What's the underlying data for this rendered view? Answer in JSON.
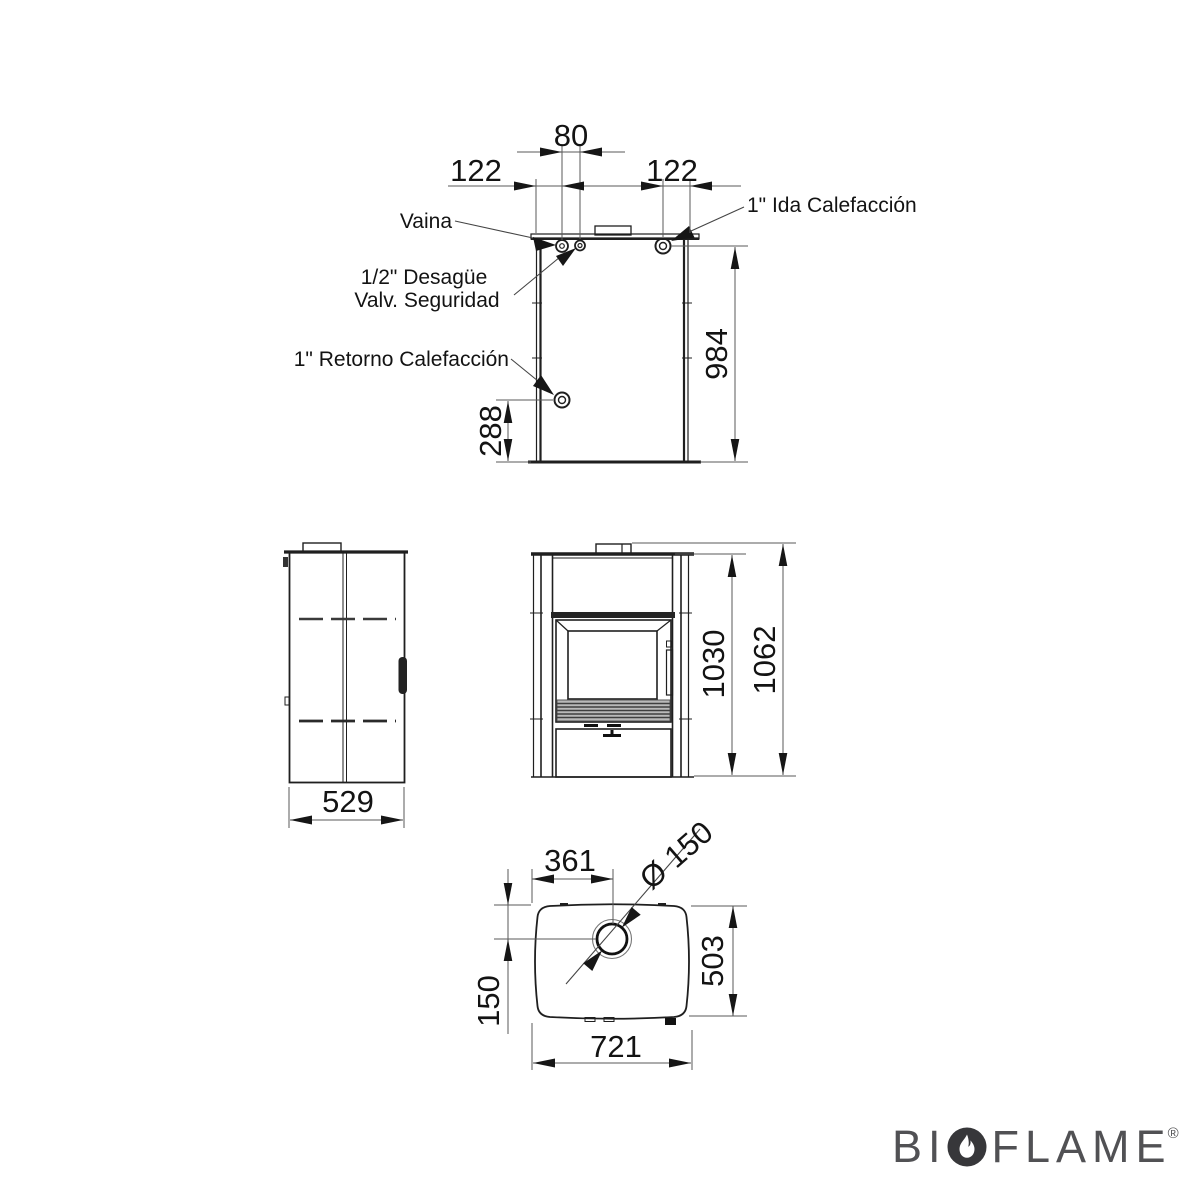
{
  "rear_view": {
    "dims": {
      "hole_spacing": "80",
      "offset_left": "122",
      "offset_right": "122",
      "height": "984",
      "return_height": "288"
    },
    "callouts": {
      "vaina": "Vaina",
      "drain_line1": "1/2\" Desagüe",
      "drain_line2": "Valv. Seguridad",
      "return_label": "1\" Retorno Calefacción",
      "flow_label": "1\" Ida Calefacción"
    }
  },
  "side_view": {
    "dims": {
      "depth": "529"
    }
  },
  "front_view": {
    "dims": {
      "body_height": "1030",
      "total_height": "1062"
    }
  },
  "plan_view": {
    "dims": {
      "flue_x": "361",
      "flue_d": "Ø 150",
      "flue_y": "150",
      "depth": "503",
      "width": "721"
    }
  },
  "logo": {
    "part1": "BI",
    "part2": "FLAME",
    "reg": "®"
  },
  "colors": {
    "line": "#1f1f1f",
    "dim_line": "#5a5a5a",
    "text": "#131313",
    "logo_text": "#515154",
    "flame_bg": "#37373a"
  }
}
